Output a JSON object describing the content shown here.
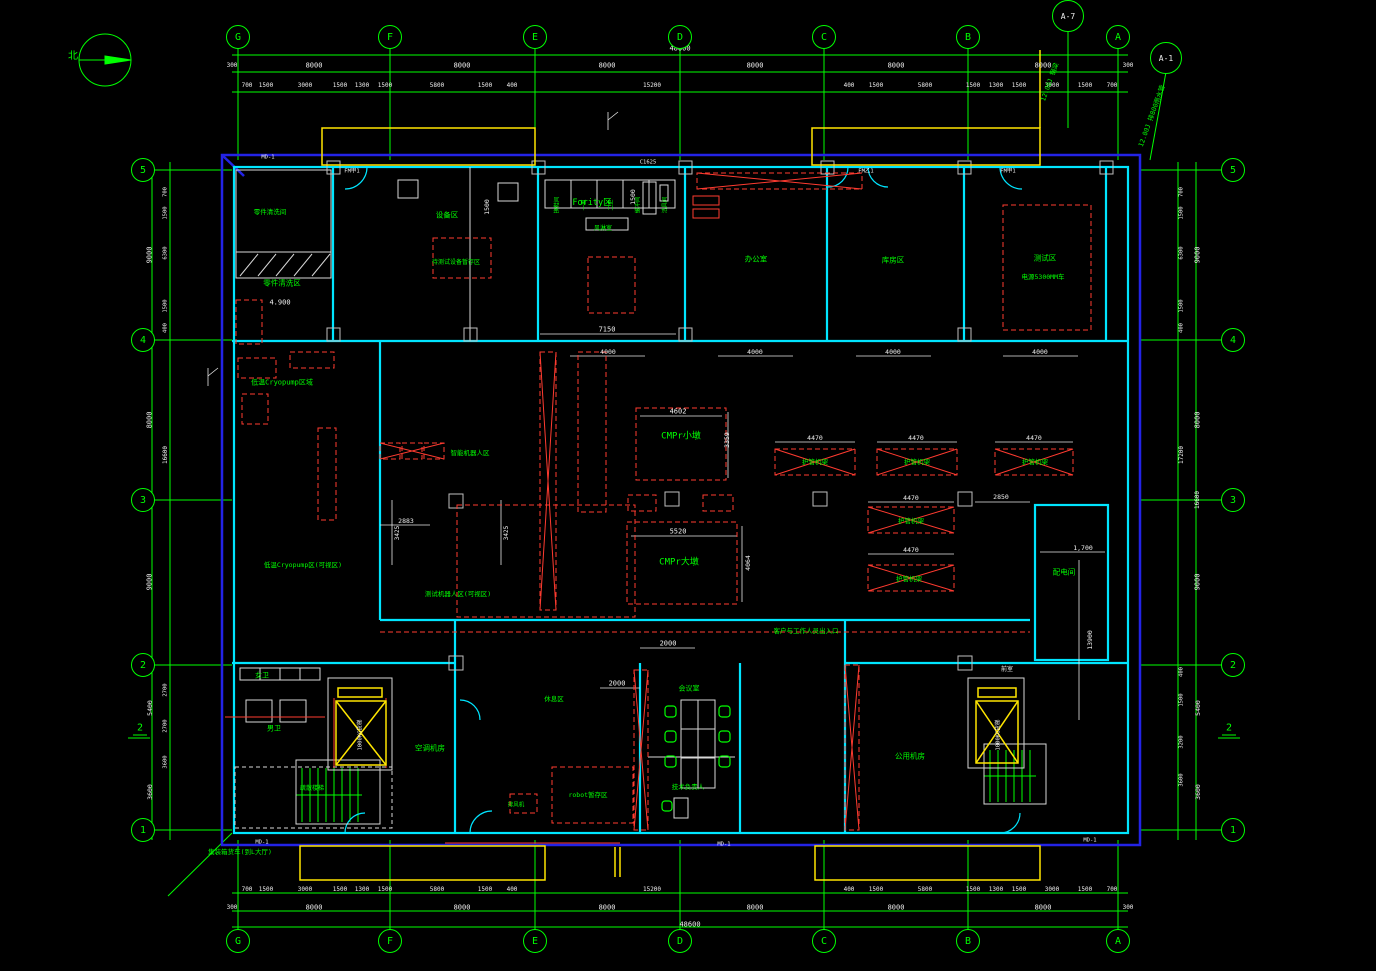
{
  "canvas": {
    "width": 1376,
    "height": 971
  },
  "colors": {
    "background": "#000000",
    "grid_green": "#00ff00",
    "wall_cyan": "#00e5ff",
    "outline_blue": "#2323e6",
    "annotation_red": "#ff3b30",
    "highlight_yellow": "#ffe600",
    "text_white": "#f0f0f0"
  },
  "compass": {
    "label": "北"
  },
  "grid": {
    "top": [
      {
        "id": "G",
        "x": 238
      },
      {
        "id": "F",
        "x": 390
      },
      {
        "id": "E",
        "x": 535
      },
      {
        "id": "D",
        "x": 680
      },
      {
        "id": "C",
        "x": 824
      },
      {
        "id": "B",
        "x": 968
      },
      {
        "id": "A",
        "x": 1118
      }
    ],
    "bottom": [
      {
        "id": "G",
        "x": 238
      },
      {
        "id": "F",
        "x": 390
      },
      {
        "id": "E",
        "x": 535
      },
      {
        "id": "D",
        "x": 680
      },
      {
        "id": "C",
        "x": 824
      },
      {
        "id": "B",
        "x": 968
      },
      {
        "id": "A",
        "x": 1118
      }
    ],
    "left": [
      {
        "id": "5",
        "y": 170
      },
      {
        "id": "4",
        "y": 340
      },
      {
        "id": "3",
        "y": 500
      },
      {
        "id": "2",
        "y": 665
      },
      {
        "id": "1",
        "y": 830
      }
    ],
    "right": [
      {
        "id": "5",
        "y": 170
      },
      {
        "id": "4",
        "y": 340
      },
      {
        "id": "3",
        "y": 500
      },
      {
        "id": "2",
        "y": 665
      },
      {
        "id": "1",
        "y": 830
      }
    ],
    "bubble_y_top": 37,
    "bubble_y_bottom": 941,
    "bubble_x_left": 143,
    "bubble_x_right": 1233
  },
  "callouts": [
    {
      "id": "A-7",
      "x": 1068,
      "y": 16,
      "note": "12.00J 钢梁",
      "nx": 1050,
      "ny": 82,
      "rot": -70
    },
    {
      "id": "A-1",
      "x": 1166,
      "y": 58,
      "note": "12.00J 排800雨水管",
      "nx": 1152,
      "ny": 116,
      "rot": -70
    }
  ],
  "section_markers": [
    {
      "label": "2",
      "x": 140,
      "y": 729
    },
    {
      "label": "2",
      "x": 1229,
      "y": 729
    }
  ],
  "labels": [
    {
      "t": "零件清洗间",
      "x": 270,
      "y": 212,
      "c": "#00ff00",
      "fs": 6.5
    },
    {
      "t": "零件清洗区",
      "x": 282,
      "y": 283,
      "c": "#00ff00",
      "fs": 7.5
    },
    {
      "t": "4.900",
      "x": 280,
      "y": 303,
      "c": "#f0f0f0",
      "fs": 7
    },
    {
      "t": "设备区",
      "x": 447,
      "y": 215,
      "c": "#00ff00",
      "fs": 7.5
    },
    {
      "t": "待测试设备暂存区",
      "x": 456,
      "y": 263,
      "c": "#00ff00",
      "fs": 6
    },
    {
      "t": "Fority区",
      "x": 592,
      "y": 203,
      "c": "#00ff00",
      "fs": 8.5
    },
    {
      "t": "风淋室",
      "x": 603,
      "y": 229,
      "c": "#00ff00",
      "fs": 6
    },
    {
      "t": "办公室",
      "x": 756,
      "y": 259,
      "c": "#00ff00",
      "fs": 7.5
    },
    {
      "t": "库房区",
      "x": 893,
      "y": 260,
      "c": "#00ff00",
      "fs": 7.5
    },
    {
      "t": "测试区",
      "x": 1045,
      "y": 258,
      "c": "#00ff00",
      "fs": 7.5
    },
    {
      "t": "电源5300MM车",
      "x": 1043,
      "y": 277,
      "c": "#00ff00",
      "fs": 6.5
    },
    {
      "t": "低温Cryopump区域",
      "x": 282,
      "y": 383,
      "c": "#00ff00",
      "fs": 7
    },
    {
      "t": "低温Cryopump区(可视区)",
      "x": 303,
      "y": 565,
      "c": "#00ff00",
      "fs": 6.5
    },
    {
      "t": "测试机器人区(可视区)",
      "x": 458,
      "y": 594,
      "c": "#00ff00",
      "fs": 6.5
    },
    {
      "t": "智能机器人区",
      "x": 470,
      "y": 453,
      "c": "#00ff00",
      "fs": 6.5
    },
    {
      "t": "CMPr小墩",
      "x": 681,
      "y": 437,
      "c": "#00ff00",
      "fs": 9
    },
    {
      "t": "CMPr大墩",
      "x": 679,
      "y": 563,
      "c": "#00ff00",
      "fs": 9
    },
    {
      "t": "护管机架",
      "x": 815,
      "y": 462,
      "c": "#00ff00",
      "fs": 6.5
    },
    {
      "t": "护管机架",
      "x": 917,
      "y": 462,
      "c": "#00ff00",
      "fs": 6.5
    },
    {
      "t": "护管机架",
      "x": 1035,
      "y": 462,
      "c": "#00ff00",
      "fs": 6.5
    },
    {
      "t": "护管机架",
      "x": 911,
      "y": 521,
      "c": "#00ff00",
      "fs": 6.5
    },
    {
      "t": "护管机架",
      "x": 909,
      "y": 579,
      "c": "#00ff00",
      "fs": 6.5
    },
    {
      "t": "配电间",
      "x": 1064,
      "y": 572,
      "c": "#00ff00",
      "fs": 7.5
    },
    {
      "t": "会议室",
      "x": 689,
      "y": 689,
      "c": "#00ff00",
      "fs": 7
    },
    {
      "t": "技术负责人",
      "x": 688,
      "y": 787,
      "c": "#00ff00",
      "fs": 6.5
    },
    {
      "t": "客户与工作人员出入口",
      "x": 806,
      "y": 631,
      "c": "#00ff00",
      "fs": 6.5
    },
    {
      "t": "女卫",
      "x": 262,
      "y": 676,
      "c": "#00ff00",
      "fs": 7
    },
    {
      "t": "男卫",
      "x": 274,
      "y": 729,
      "c": "#00ff00",
      "fs": 7
    },
    {
      "t": "疏散楼梯",
      "x": 312,
      "y": 789,
      "c": "#00ff00",
      "fs": 6
    },
    {
      "t": "空调机房",
      "x": 430,
      "y": 748,
      "c": "#00ff00",
      "fs": 7.5
    },
    {
      "t": "公用机房",
      "x": 910,
      "y": 756,
      "c": "#00ff00",
      "fs": 7.5
    },
    {
      "t": "休息区",
      "x": 554,
      "y": 699,
      "c": "#00ff00",
      "fs": 6.5
    },
    {
      "t": "robot暂存区",
      "x": 588,
      "y": 795,
      "c": "#00ff00",
      "fs": 6.5
    },
    {
      "t": "排风机",
      "x": 516,
      "y": 806,
      "c": "#00ff00",
      "fs": 5.5
    },
    {
      "t": "集装箱货车(到L大厅)",
      "x": 240,
      "y": 852,
      "c": "#00ff00",
      "fs": 6.5
    },
    {
      "t": "前室",
      "x": 1007,
      "y": 670,
      "c": "#f0f0f0",
      "fs": 6
    },
    {
      "t": "1000KG货梯",
      "x": 361,
      "y": 735,
      "c": "#f0f0f0",
      "fs": 5.5,
      "r": -90
    },
    {
      "t": "1000KG货梯",
      "x": 999,
      "y": 735,
      "c": "#f0f0f0",
      "fs": 5.5,
      "r": -90
    },
    {
      "t": "换鞋间",
      "x": 558,
      "y": 205,
      "c": "#00ff00",
      "fs": 5.5,
      "r": -90
    },
    {
      "t": "一更",
      "x": 585,
      "y": 205,
      "c": "#00ff00",
      "fs": 5.5,
      "r": -90
    },
    {
      "t": "二更",
      "x": 612,
      "y": 205,
      "c": "#00ff00",
      "fs": 5.5,
      "r": -90
    },
    {
      "t": "缓冲间",
      "x": 639,
      "y": 205,
      "c": "#00ff00",
      "fs": 5.5,
      "r": -90
    },
    {
      "t": "洁具间",
      "x": 666,
      "y": 205,
      "c": "#00ff00",
      "fs": 5.5,
      "r": -90
    },
    {
      "t": "48600",
      "x": 680,
      "y": 49,
      "c": "#f0f0f0",
      "fs": 7
    },
    {
      "t": "300",
      "x": 232,
      "y": 66,
      "c": "#f0f0f0",
      "fs": 6
    },
    {
      "t": "8000",
      "x": 314,
      "y": 66,
      "c": "#f0f0f0",
      "fs": 7
    },
    {
      "t": "8000",
      "x": 462,
      "y": 66,
      "c": "#f0f0f0",
      "fs": 7
    },
    {
      "t": "8000",
      "x": 607,
      "y": 66,
      "c": "#f0f0f0",
      "fs": 7
    },
    {
      "t": "8000",
      "x": 755,
      "y": 66,
      "c": "#f0f0f0",
      "fs": 7
    },
    {
      "t": "8000",
      "x": 896,
      "y": 66,
      "c": "#f0f0f0",
      "fs": 7
    },
    {
      "t": "8000",
      "x": 1043,
      "y": 66,
      "c": "#f0f0f0",
      "fs": 7
    },
    {
      "t": "300",
      "x": 1128,
      "y": 66,
      "c": "#f0f0f0",
      "fs": 6
    },
    {
      "t": "700",
      "x": 247,
      "y": 86,
      "c": "#f0f0f0",
      "fs": 6
    },
    {
      "t": "1500",
      "x": 266,
      "y": 86,
      "c": "#f0f0f0",
      "fs": 6
    },
    {
      "t": "3000",
      "x": 305,
      "y": 86,
      "c": "#f0f0f0",
      "fs": 6
    },
    {
      "t": "1500",
      "x": 340,
      "y": 86,
      "c": "#f0f0f0",
      "fs": 6
    },
    {
      "t": "1300",
      "x": 362,
      "y": 86,
      "c": "#f0f0f0",
      "fs": 6
    },
    {
      "t": "1500",
      "x": 385,
      "y": 86,
      "c": "#f0f0f0",
      "fs": 6
    },
    {
      "t": "5800",
      "x": 437,
      "y": 86,
      "c": "#f0f0f0",
      "fs": 6
    },
    {
      "t": "1500",
      "x": 485,
      "y": 86,
      "c": "#f0f0f0",
      "fs": 6
    },
    {
      "t": "400",
      "x": 512,
      "y": 86,
      "c": "#f0f0f0",
      "fs": 6
    },
    {
      "t": "15200",
      "x": 652,
      "y": 86,
      "c": "#f0f0f0",
      "fs": 6
    },
    {
      "t": "400",
      "x": 849,
      "y": 86,
      "c": "#f0f0f0",
      "fs": 6
    },
    {
      "t": "1500",
      "x": 876,
      "y": 86,
      "c": "#f0f0f0",
      "fs": 6
    },
    {
      "t": "5800",
      "x": 925,
      "y": 86,
      "c": "#f0f0f0",
      "fs": 6
    },
    {
      "t": "1500",
      "x": 973,
      "y": 86,
      "c": "#f0f0f0",
      "fs": 6
    },
    {
      "t": "1300",
      "x": 996,
      "y": 86,
      "c": "#f0f0f0",
      "fs": 6
    },
    {
      "t": "1500",
      "x": 1019,
      "y": 86,
      "c": "#f0f0f0",
      "fs": 6
    },
    {
      "t": "3000",
      "x": 1052,
      "y": 86,
      "c": "#f0f0f0",
      "fs": 6
    },
    {
      "t": "1500",
      "x": 1085,
      "y": 86,
      "c": "#f0f0f0",
      "fs": 6
    },
    {
      "t": "700",
      "x": 1112,
      "y": 86,
      "c": "#f0f0f0",
      "fs": 6
    },
    {
      "t": "700",
      "x": 247,
      "y": 890,
      "c": "#f0f0f0",
      "fs": 6
    },
    {
      "t": "1500",
      "x": 266,
      "y": 890,
      "c": "#f0f0f0",
      "fs": 6
    },
    {
      "t": "3000",
      "x": 305,
      "y": 890,
      "c": "#f0f0f0",
      "fs": 6
    },
    {
      "t": "1500",
      "x": 340,
      "y": 890,
      "c": "#f0f0f0",
      "fs": 6
    },
    {
      "t": "1300",
      "x": 362,
      "y": 890,
      "c": "#f0f0f0",
      "fs": 6
    },
    {
      "t": "1500",
      "x": 385,
      "y": 890,
      "c": "#f0f0f0",
      "fs": 6
    },
    {
      "t": "5800",
      "x": 437,
      "y": 890,
      "c": "#f0f0f0",
      "fs": 6
    },
    {
      "t": "1500",
      "x": 485,
      "y": 890,
      "c": "#f0f0f0",
      "fs": 6
    },
    {
      "t": "400",
      "x": 512,
      "y": 890,
      "c": "#f0f0f0",
      "fs": 6
    },
    {
      "t": "15200",
      "x": 652,
      "y": 890,
      "c": "#f0f0f0",
      "fs": 6
    },
    {
      "t": "400",
      "x": 849,
      "y": 890,
      "c": "#f0f0f0",
      "fs": 6
    },
    {
      "t": "1500",
      "x": 876,
      "y": 890,
      "c": "#f0f0f0",
      "fs": 6
    },
    {
      "t": "5800",
      "x": 925,
      "y": 890,
      "c": "#f0f0f0",
      "fs": 6
    },
    {
      "t": "1500",
      "x": 973,
      "y": 890,
      "c": "#f0f0f0",
      "fs": 6
    },
    {
      "t": "1300",
      "x": 996,
      "y": 890,
      "c": "#f0f0f0",
      "fs": 6
    },
    {
      "t": "1500",
      "x": 1019,
      "y": 890,
      "c": "#f0f0f0",
      "fs": 6
    },
    {
      "t": "3000",
      "x": 1052,
      "y": 890,
      "c": "#f0f0f0",
      "fs": 6
    },
    {
      "t": "1500",
      "x": 1085,
      "y": 890,
      "c": "#f0f0f0",
      "fs": 6
    },
    {
      "t": "700",
      "x": 1112,
      "y": 890,
      "c": "#f0f0f0",
      "fs": 6
    },
    {
      "t": "300",
      "x": 232,
      "y": 908,
      "c": "#f0f0f0",
      "fs": 6
    },
    {
      "t": "8000",
      "x": 314,
      "y": 908,
      "c": "#f0f0f0",
      "fs": 7
    },
    {
      "t": "8000",
      "x": 462,
      "y": 908,
      "c": "#f0f0f0",
      "fs": 7
    },
    {
      "t": "8000",
      "x": 607,
      "y": 908,
      "c": "#f0f0f0",
      "fs": 7
    },
    {
      "t": "8000",
      "x": 755,
      "y": 908,
      "c": "#f0f0f0",
      "fs": 7
    },
    {
      "t": "8000",
      "x": 896,
      "y": 908,
      "c": "#f0f0f0",
      "fs": 7
    },
    {
      "t": "8000",
      "x": 1043,
      "y": 908,
      "c": "#f0f0f0",
      "fs": 7
    },
    {
      "t": "300",
      "x": 1128,
      "y": 908,
      "c": "#f0f0f0",
      "fs": 6
    },
    {
      "t": "48600",
      "x": 690,
      "y": 925,
      "c": "#f0f0f0",
      "fs": 7
    },
    {
      "t": "9000",
      "x": 150,
      "y": 255,
      "c": "#f0f0f0",
      "fs": 7,
      "r": -90
    },
    {
      "t": "8000",
      "x": 150,
      "y": 420,
      "c": "#f0f0f0",
      "fs": 7,
      "r": -90
    },
    {
      "t": "17200",
      "x": 150,
      "y": 500,
      "c": "#f0f0f0",
      "fs": 6,
      "r": -90
    },
    {
      "t": "9000",
      "x": 150,
      "y": 582,
      "c": "#f0f0f0",
      "fs": 7,
      "r": -90
    },
    {
      "t": "5400",
      "x": 150,
      "y": 708,
      "c": "#f0f0f0",
      "fs": 6.5,
      "r": -90
    },
    {
      "t": "3600",
      "x": 150,
      "y": 792,
      "c": "#f0f0f0",
      "fs": 6.5,
      "r": -90
    },
    {
      "t": "700",
      "x": 166,
      "y": 192,
      "c": "#f0f0f0",
      "fs": 5.5,
      "r": -90
    },
    {
      "t": "1500",
      "x": 166,
      "y": 213,
      "c": "#f0f0f0",
      "fs": 5.5,
      "r": -90
    },
    {
      "t": "6300",
      "x": 166,
      "y": 253,
      "c": "#f0f0f0",
      "fs": 5.5,
      "r": -90
    },
    {
      "t": "1500",
      "x": 166,
      "y": 306,
      "c": "#f0f0f0",
      "fs": 5.5,
      "r": -90
    },
    {
      "t": "400",
      "x": 166,
      "y": 328,
      "c": "#f0f0f0",
      "fs": 5.5,
      "r": -90
    },
    {
      "t": "16600",
      "x": 166,
      "y": 455,
      "c": "#f0f0f0",
      "fs": 6,
      "r": -90
    },
    {
      "t": "2700",
      "x": 166,
      "y": 690,
      "c": "#f0f0f0",
      "fs": 5.5,
      "r": -90
    },
    {
      "t": "2700",
      "x": 166,
      "y": 726,
      "c": "#f0f0f0",
      "fs": 5.5,
      "r": -90
    },
    {
      "t": "3600",
      "x": 166,
      "y": 762,
      "c": "#f0f0f0",
      "fs": 5.5,
      "r": -90
    },
    {
      "t": "9000",
      "x": 1198,
      "y": 255,
      "c": "#f0f0f0",
      "fs": 7,
      "r": -90
    },
    {
      "t": "8000",
      "x": 1198,
      "y": 420,
      "c": "#f0f0f0",
      "fs": 7,
      "r": -90
    },
    {
      "t": "16600",
      "x": 1198,
      "y": 500,
      "c": "#f0f0f0",
      "fs": 6,
      "r": -90
    },
    {
      "t": "9000",
      "x": 1198,
      "y": 582,
      "c": "#f0f0f0",
      "fs": 7,
      "r": -90
    },
    {
      "t": "5400",
      "x": 1198,
      "y": 708,
      "c": "#f0f0f0",
      "fs": 6.5,
      "r": -90
    },
    {
      "t": "3600",
      "x": 1198,
      "y": 792,
      "c": "#f0f0f0",
      "fs": 6.5,
      "r": -90
    },
    {
      "t": "700",
      "x": 1182,
      "y": 192,
      "c": "#f0f0f0",
      "fs": 5.5,
      "r": -90
    },
    {
      "t": "1500",
      "x": 1182,
      "y": 213,
      "c": "#f0f0f0",
      "fs": 5.5,
      "r": -90
    },
    {
      "t": "6300",
      "x": 1182,
      "y": 253,
      "c": "#f0f0f0",
      "fs": 5.5,
      "r": -90
    },
    {
      "t": "1500",
      "x": 1182,
      "y": 306,
      "c": "#f0f0f0",
      "fs": 5.5,
      "r": -90
    },
    {
      "t": "400",
      "x": 1182,
      "y": 328,
      "c": "#f0f0f0",
      "fs": 5.5,
      "r": -90
    },
    {
      "t": "17200",
      "x": 1182,
      "y": 455,
      "c": "#f0f0f0",
      "fs": 6,
      "r": -90
    },
    {
      "t": "400",
      "x": 1182,
      "y": 672,
      "c": "#f0f0f0",
      "fs": 5.5,
      "r": -90
    },
    {
      "t": "1500",
      "x": 1182,
      "y": 700,
      "c": "#f0f0f0",
      "fs": 5.5,
      "r": -90
    },
    {
      "t": "3200",
      "x": 1182,
      "y": 742,
      "c": "#f0f0f0",
      "fs": 5.5,
      "r": -90
    },
    {
      "t": "3600",
      "x": 1182,
      "y": 780,
      "c": "#f0f0f0",
      "fs": 5.5,
      "r": -90
    },
    {
      "t": "7150",
      "x": 607,
      "y": 330,
      "c": "#f0f0f0",
      "fs": 7
    },
    {
      "t": "4000",
      "x": 608,
      "y": 352,
      "c": "#f0f0f0",
      "fs": 6.5
    },
    {
      "t": "4000",
      "x": 755,
      "y": 352,
      "c": "#f0f0f0",
      "fs": 6.5
    },
    {
      "t": "4000",
      "x": 893,
      "y": 352,
      "c": "#f0f0f0",
      "fs": 6.5
    },
    {
      "t": "4000",
      "x": 1040,
      "y": 352,
      "c": "#f0f0f0",
      "fs": 6.5
    },
    {
      "t": "4602",
      "x": 678,
      "y": 412,
      "c": "#f0f0f0",
      "fs": 7
    },
    {
      "t": "3359",
      "x": 727,
      "y": 440,
      "c": "#f0f0f0",
      "fs": 6.5,
      "r": -90
    },
    {
      "t": "5520",
      "x": 678,
      "y": 532,
      "c": "#f0f0f0",
      "fs": 7
    },
    {
      "t": "4064",
      "x": 748,
      "y": 563,
      "c": "#f0f0f0",
      "fs": 6.5,
      "r": -90
    },
    {
      "t": "4470",
      "x": 815,
      "y": 438,
      "c": "#f0f0f0",
      "fs": 6.5
    },
    {
      "t": "4470",
      "x": 916,
      "y": 438,
      "c": "#f0f0f0",
      "fs": 6.5
    },
    {
      "t": "4470",
      "x": 1034,
      "y": 438,
      "c": "#f0f0f0",
      "fs": 6.5
    },
    {
      "t": "4470",
      "x": 911,
      "y": 498,
      "c": "#f0f0f0",
      "fs": 6.5
    },
    {
      "t": "4470",
      "x": 911,
      "y": 550,
      "c": "#f0f0f0",
      "fs": 6.5
    },
    {
      "t": "2850",
      "x": 1001,
      "y": 497,
      "c": "#f0f0f0",
      "fs": 6.5
    },
    {
      "t": "2883",
      "x": 406,
      "y": 521,
      "c": "#f0f0f0",
      "fs": 6.5
    },
    {
      "t": "3425",
      "x": 398,
      "y": 533,
      "c": "#f0f0f0",
      "fs": 6,
      "r": -90
    },
    {
      "t": "3425",
      "x": 507,
      "y": 533,
      "c": "#f0f0f0",
      "fs": 6,
      "r": -90
    },
    {
      "t": "1,700",
      "x": 1083,
      "y": 548,
      "c": "#f0f0f0",
      "fs": 6.5
    },
    {
      "t": "13900",
      "x": 1090,
      "y": 640,
      "c": "#f0f0f0",
      "fs": 6.5,
      "r": -90
    },
    {
      "t": "2000",
      "x": 668,
      "y": 644,
      "c": "#f0f0f0",
      "fs": 7
    },
    {
      "t": "2000",
      "x": 617,
      "y": 684,
      "c": "#f0f0f0",
      "fs": 7
    },
    {
      "t": "1500",
      "x": 633,
      "y": 197,
      "c": "#f0f0f0",
      "fs": 6.5,
      "r": -90
    },
    {
      "t": "1500",
      "x": 487,
      "y": 207,
      "c": "#f0f0f0",
      "fs": 6.5,
      "r": -90
    },
    {
      "t": "MD-1",
      "x": 268,
      "y": 158,
      "c": "#f0f0f0",
      "fs": 5.5
    },
    {
      "t": "MD-1",
      "x": 262,
      "y": 843,
      "c": "#f0f0f0",
      "fs": 5.5
    },
    {
      "t": "MD-1",
      "x": 724,
      "y": 845,
      "c": "#f0f0f0",
      "fs": 5.5
    },
    {
      "t": "MD-1",
      "x": 1090,
      "y": 841,
      "c": "#f0f0f0",
      "fs": 5.5
    },
    {
      "t": "C1625",
      "x": 648,
      "y": 163,
      "c": "#f0f0f0",
      "fs": 5.5
    },
    {
      "t": "FM甲1",
      "x": 352,
      "y": 172,
      "c": "#f0f0f0",
      "fs": 5.5
    },
    {
      "t": "FM甲1",
      "x": 1008,
      "y": 172,
      "c": "#f0f0f0",
      "fs": 5.5
    },
    {
      "t": "FM乙1",
      "x": 866,
      "y": 172,
      "c": "#f0f0f0",
      "fs": 5.5
    }
  ]
}
